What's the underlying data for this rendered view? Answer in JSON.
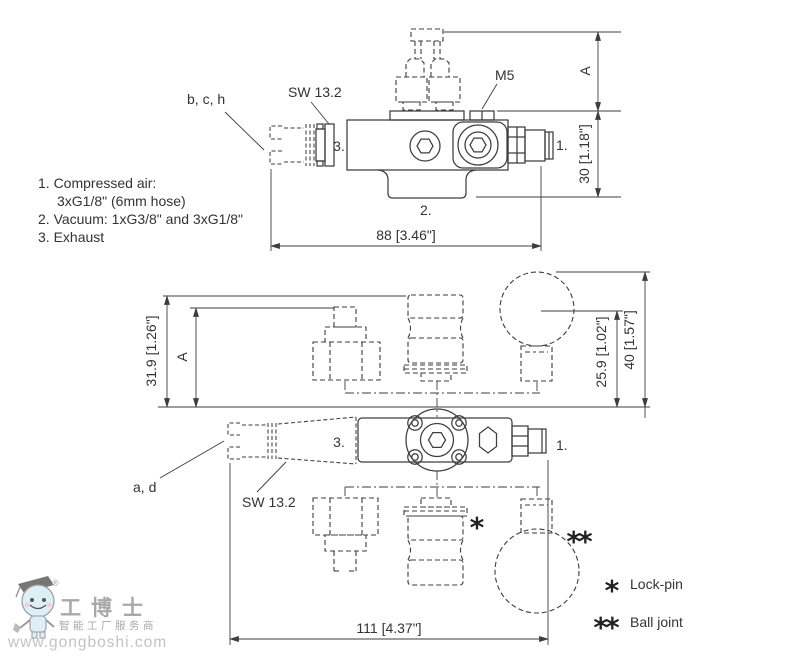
{
  "top_view": {
    "label_bch": "b, c, h",
    "label_sw132": "SW 13.2",
    "label_m5": "M5",
    "port_3": "3.",
    "port_1": "1.",
    "port_2": "2.",
    "dim_a": "A",
    "dim_height": "30 [1.18\"]",
    "dim_length": "88 [3.46\"]"
  },
  "notes": {
    "line1": "1. Compressed air:",
    "line2": "3xG1/8\" (6mm hose)",
    "line3": "2. Vacuum: 1xG3/8\" and 3xG1/8\"",
    "line4": "3. Exhaust"
  },
  "bottom_view": {
    "dim_319": "31.9 [1.26\"]",
    "dim_a": "A",
    "dim_259": "25.9 [1.02\"]",
    "dim_40": "40 [1.57\"]",
    "dim_111": "111 [4.37\"]",
    "label_ad": "a, d",
    "label_sw132": "SW 13.2",
    "port_3": "3.",
    "port_1": "1.",
    "lockpin_marker": "*",
    "balljoint_marker": "**"
  },
  "legend": {
    "lockpin_symbol": "*",
    "lockpin_label": "Lock-pin",
    "balljoint_symbol": "**",
    "balljoint_label": "Ball joint"
  },
  "watermark": {
    "brand": "工博士",
    "registered": "®",
    "slogan": "智能工厂服务商",
    "url": "www.gongboshi.com"
  },
  "colors": {
    "line": "#3d3d3d",
    "text": "#333333",
    "mascot_blue": "#d9edf7",
    "watermark_gray": "#9a9a9a"
  }
}
